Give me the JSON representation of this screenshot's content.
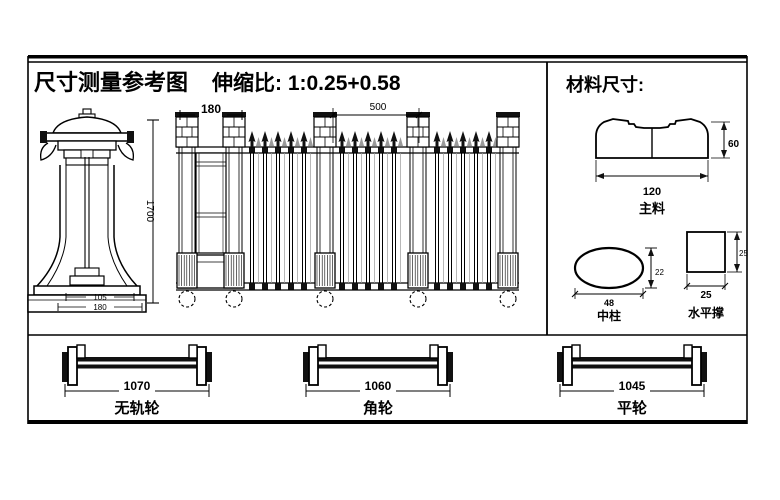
{
  "header": {
    "title": "尺寸测量参考图",
    "ratio": "伸缩比: 1:0.25+0.58"
  },
  "materials": {
    "title": "材料尺寸:",
    "main_profile": {
      "label": "主料",
      "width": "120",
      "height": "60"
    },
    "oval_profile": {
      "label": "中柱",
      "width": "48",
      "height": "22"
    },
    "square_profile": {
      "label": "水平撑",
      "width": "25",
      "height": "25"
    }
  },
  "gate": {
    "bay_width": "180",
    "section_width": "500",
    "height": "1700",
    "base_dim_top": "105",
    "base_dim_bottom": "180"
  },
  "wheels": [
    {
      "dim": "1070",
      "label": "无轨轮"
    },
    {
      "dim": "1060",
      "label": "角轮"
    },
    {
      "dim": "1045",
      "label": "平轮"
    }
  ]
}
